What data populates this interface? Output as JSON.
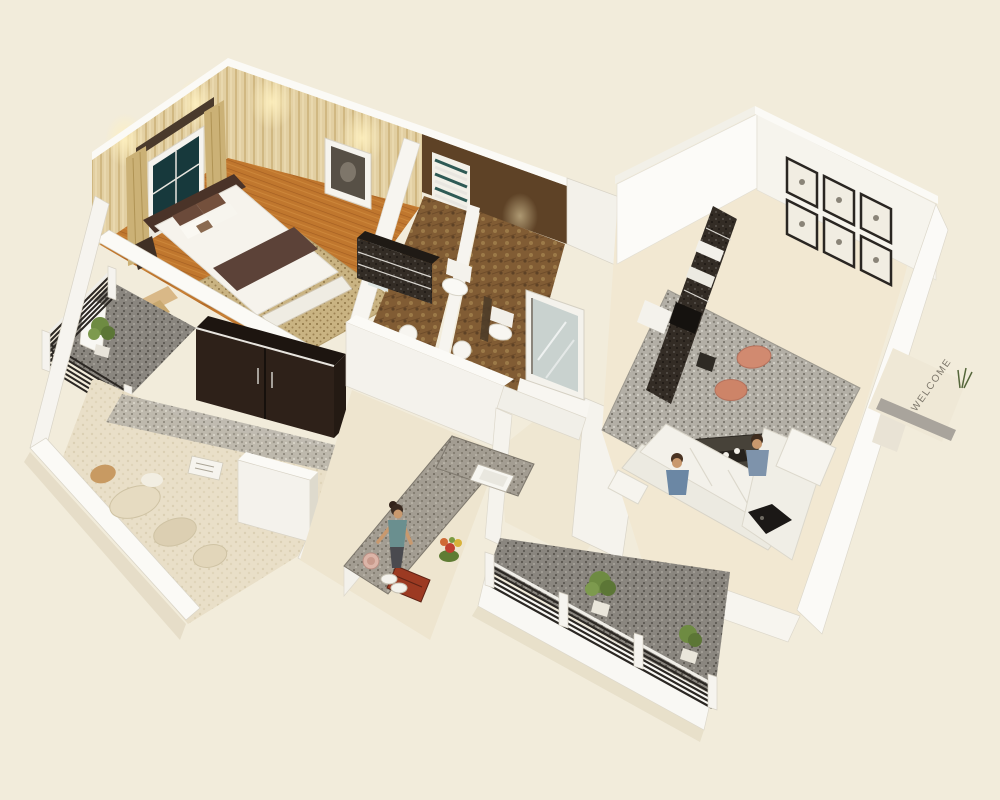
{
  "scene": {
    "type": "3d-isometric-floor-plan-render",
    "entrance": {
      "doormat_text": "WELCOME",
      "objects": [
        "doormat",
        "potted-plant",
        "entry-landing"
      ]
    },
    "gallery_frames_count": 6,
    "people": [
      {
        "location": "living-room-sofa",
        "count": 2
      },
      {
        "location": "kitchen-counter",
        "count": 1
      }
    ],
    "rooms": [
      {
        "id": "master-bedroom",
        "label": "Master Bedroom",
        "objects": [
          "double-bed",
          "teal-window",
          "curtains",
          "pelmet",
          "wall-art",
          "dark-dresser",
          "dotted-rug",
          "foot-bench",
          "steps-to-balcony"
        ]
      },
      {
        "id": "bathroom-1",
        "label": "Bathroom 1",
        "objects": [
          "toilet",
          "wash-basin",
          "louver-window",
          "mirror"
        ]
      },
      {
        "id": "bathroom-2",
        "label": "Bathroom 2",
        "objects": [
          "toilet",
          "wash-basin",
          "shower-fixture"
        ]
      },
      {
        "id": "hallway",
        "label": "Hallway",
        "objects": [
          "glass-door-panel"
        ]
      },
      {
        "id": "living-room",
        "label": "Living Room",
        "objects": [
          "l-shaped-sofa",
          "coffee-table",
          "tv-shelf-unit",
          "gallery-wall",
          "gray-area-rug",
          "orange-floor-cushions",
          "two-people"
        ]
      },
      {
        "id": "kitchen",
        "label": "Kitchen",
        "objects": [
          "l-shaped-granite-counter",
          "sink",
          "red-hob",
          "plates",
          "pink-pot",
          "flower-bunch",
          "woman-cooking"
        ]
      },
      {
        "id": "second-bedroom",
        "label": "Second Bedroom",
        "objects": [
          "dark-wardrobe",
          "beige-carpet",
          "floor-cushions",
          "open-magazine",
          "white-cabinet"
        ]
      },
      {
        "id": "bedroom-balcony",
        "label": "Bedroom Balcony",
        "objects": [
          "slat-railing",
          "potted-plant",
          "granite-floor",
          "open-door"
        ]
      },
      {
        "id": "rear-balcony",
        "label": "Rear Balcony",
        "objects": [
          "slat-railing",
          "two-potted-plants",
          "granite-floor",
          "white-parapet"
        ]
      }
    ],
    "colors": {
      "background": "#f2ecdb",
      "wall_white": "#fafaf6",
      "wall_shade": "#eceae2",
      "bedroom_wall": "#e2cfa2",
      "wood_floor": "#c0772e",
      "bed_linen": "#f6f3ec",
      "bed_runner": "#5c4238",
      "headboard": "#4a3328",
      "bathroom_wall": "#5e4226",
      "bathroom_floor": "#815c34",
      "living_floor": "#f2e8d2",
      "sofa": "#f3f1ea",
      "rug_gray": "#b3afa6",
      "pouf": "#d18a70",
      "tv_unit": "#332c25",
      "counter_granite": "#a39d92",
      "carpet": "#e9dfc8",
      "wardrobe": "#2e2119",
      "balcony_floor": "#8a867f",
      "railing": "#2b2723",
      "plant": "#6e8b42",
      "curtain": "#cbb176",
      "window_glass": "#17393c",
      "doormat": "#a9a49c",
      "doormat_text_color": "#7d776b",
      "stove": "#9c3a22",
      "glass_door": "#c9d2cf",
      "shirt_blue": "#6b87a4",
      "skin": "#c9996e"
    }
  }
}
